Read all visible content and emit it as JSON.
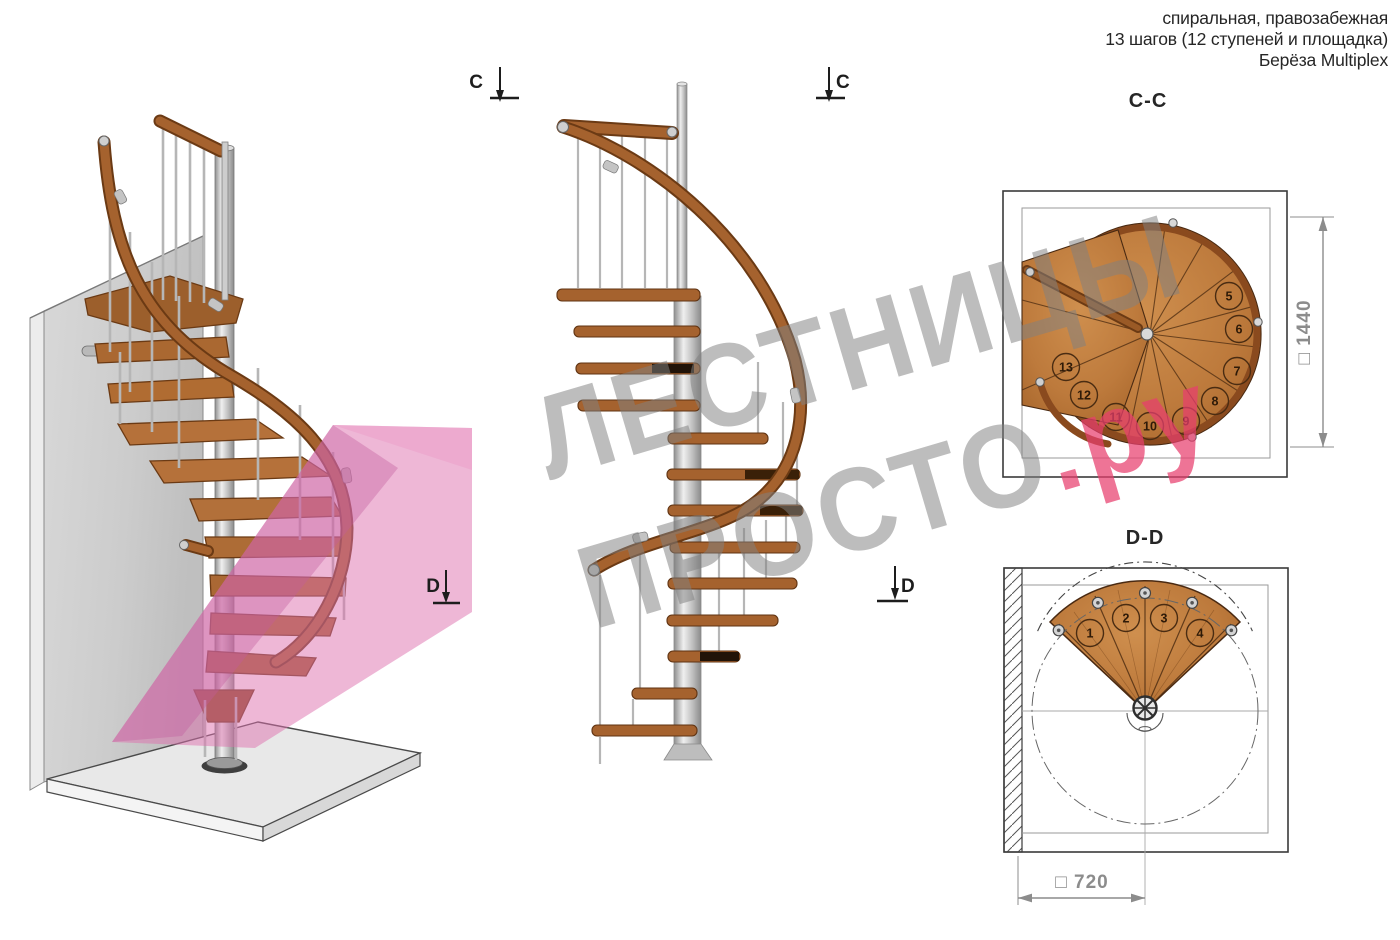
{
  "header": {
    "line1": "спиральная, правозабежная",
    "line2": "13 шагов (12 ступеней и площадка)",
    "line3": "Берёза Multiplex"
  },
  "plan_cc": {
    "label": "C-C",
    "marker_letter": "C",
    "dimension": "□ 1440",
    "numbers": [
      "5",
      "6",
      "7",
      "8",
      "9",
      "10",
      "11",
      "12",
      "13"
    ]
  },
  "plan_dd": {
    "label": "D-D",
    "marker_letter": "D",
    "dimension": "□ 720",
    "numbers": [
      "1",
      "2",
      "3",
      "4"
    ]
  },
  "watermark": {
    "line1": "ЛЕСТНИЦЫ",
    "line2_gray": "ПРОСТО",
    "line2_pink": ".ру"
  },
  "colors": {
    "wood": "#b5713a",
    "wood_dark": "#6b3a14",
    "steel": "#c9c9c9",
    "pink_plane": "#d76fae",
    "watermark_gray": "#8a8a8a",
    "watermark_pink": "#e84b78",
    "dimension_gray": "#8c8c8c",
    "frame_line": "#3a3a3a"
  }
}
